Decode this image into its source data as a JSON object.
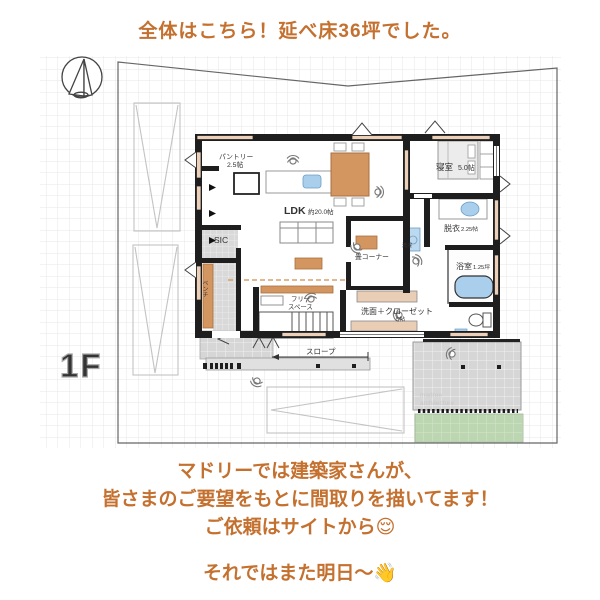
{
  "header": {
    "title": "全体はこちら！延べ床36坪でした。"
  },
  "plan": {
    "floor_label": "1F",
    "labels": {
      "pantry_name": "パントリー",
      "pantry_size": "2.5帖",
      "ldk_name": "LDK",
      "ldk_size": "約20.0帖",
      "sic": "SIC",
      "bench": "ベンチ",
      "free1": "フリー",
      "free2": "スペース",
      "tatami": "畳コーナー",
      "laundry": "洗濯",
      "washcloset_name": "洗面＋クローゼット",
      "washcloset_size": "5帖",
      "dressing_name": "脱衣",
      "dressing_size": "2.25帖",
      "bath_name": "浴室",
      "bath_size": "1.25坪",
      "bedroom_name": "寝室",
      "bedroom_size": "5.0帖",
      "slope": "スロープ",
      "watermark1": "madree",
      "watermark2": "architecture"
    }
  },
  "footer": {
    "line1": "マドリーでは建築家さんが、",
    "line2": "皆さまのご要望をもとに間取りを描いてます！",
    "line3": "ご依頼はサイトから😌",
    "line4": "それではまた明日〜👋"
  },
  "colors": {
    "accent_text": "#c4702f",
    "wall_beige": "#ecd0ba",
    "wood_tan": "#d49660",
    "fixture_blue": "#a9cfec",
    "tile_gray": "#d6d6d6",
    "lawn_green": "#bcd6b1",
    "wall_black": "#1e1e1e"
  }
}
